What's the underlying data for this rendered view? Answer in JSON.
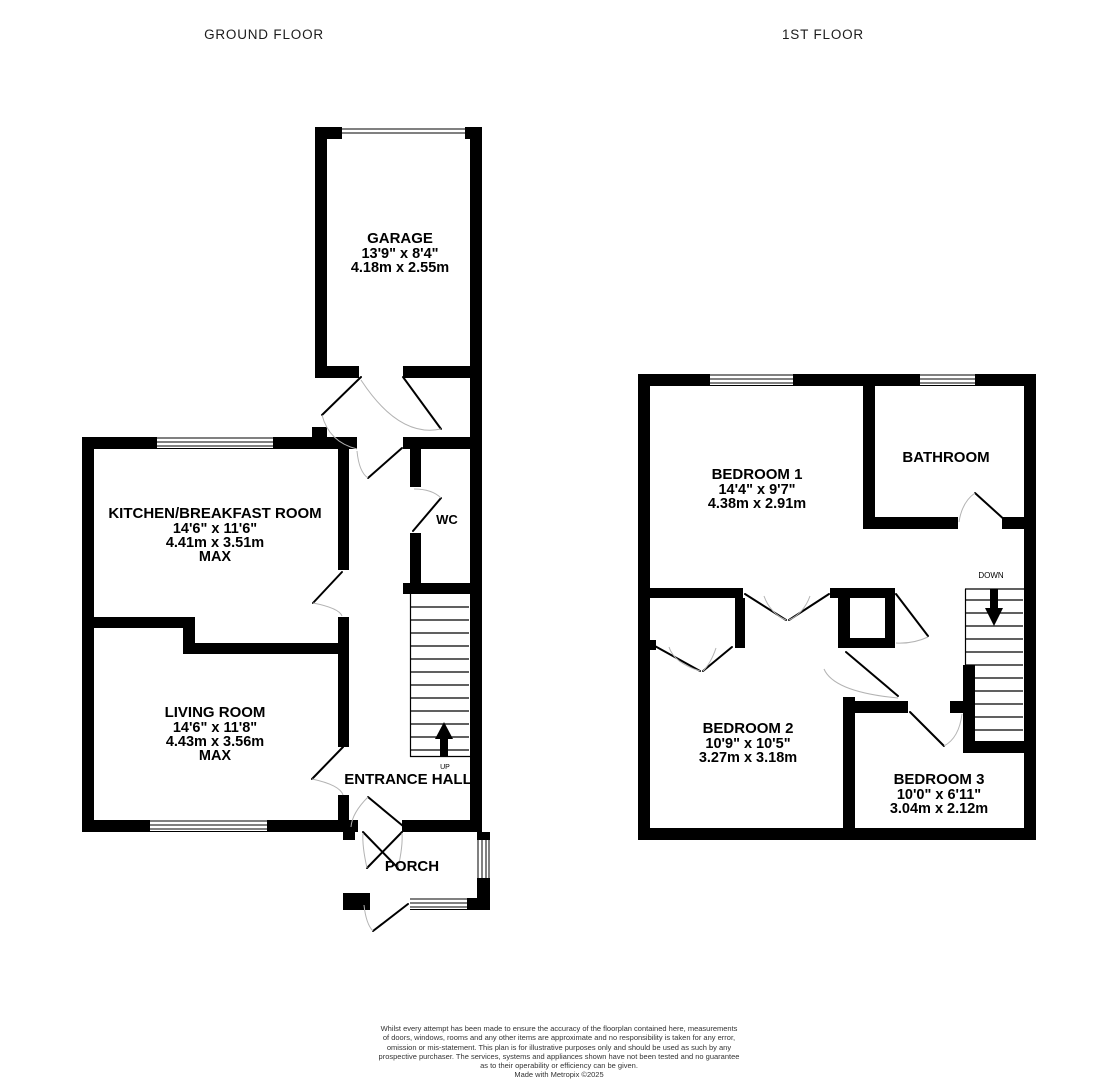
{
  "titles": {
    "ground_floor": "GROUND FLOOR",
    "first_floor": "1ST FLOOR"
  },
  "ground_floor": {
    "garage": {
      "name": "GARAGE",
      "size_imperial": "13'9\" x 8'4\"",
      "size_metric": "4.18m x 2.55m"
    },
    "kitchen": {
      "name": "KITCHEN/BREAKFAST ROOM",
      "size_imperial": "14'6\" x 11'6\"",
      "size_metric": "4.41m x 3.51m",
      "qualifier": "MAX"
    },
    "living_room": {
      "name": "LIVING ROOM",
      "size_imperial": "14'6\" x 11'8\"",
      "size_metric": "4.43m x 3.56m",
      "qualifier": "MAX"
    },
    "wc": {
      "name": "WC"
    },
    "entrance_hall": {
      "name": "ENTRANCE HALL"
    },
    "porch": {
      "name": "PORCH"
    },
    "stairs_label": "UP"
  },
  "first_floor": {
    "bedroom_1": {
      "name": "BEDROOM 1",
      "size_imperial": "14'4\" x 9'7\"",
      "size_metric": "4.38m x 2.91m"
    },
    "bathroom": {
      "name": "BATHROOM"
    },
    "bedroom_2": {
      "name": "BEDROOM 2",
      "size_imperial": "10'9\" x 10'5\"",
      "size_metric": "3.27m x 3.18m"
    },
    "bedroom_3": {
      "name": "BEDROOM 3",
      "size_imperial": "10'0\" x 6'11\"",
      "size_metric": "3.04m x 2.12m"
    },
    "stairs_label": "DOWN"
  },
  "disclaimer": {
    "lines": [
      "Whilst every attempt has been made to ensure the accuracy of the floorplan contained here, measurements",
      "of doors, windows, rooms and any other items are approximate and no responsibility is taken for any error,",
      "omission or mis-statement. This plan is for illustrative purposes only and should be used as such by any",
      "prospective purchaser. The services, systems and appliances shown have not been tested and no guarantee",
      "as to their operability or efficiency can be given.",
      "Made with Metropix ©2025"
    ]
  },
  "colors": {
    "wall": "#000000",
    "background": "#ffffff",
    "door_arc": "#b3b3b3",
    "title_text": "#1c1c1c",
    "disclaimer_text": "#333333"
  }
}
